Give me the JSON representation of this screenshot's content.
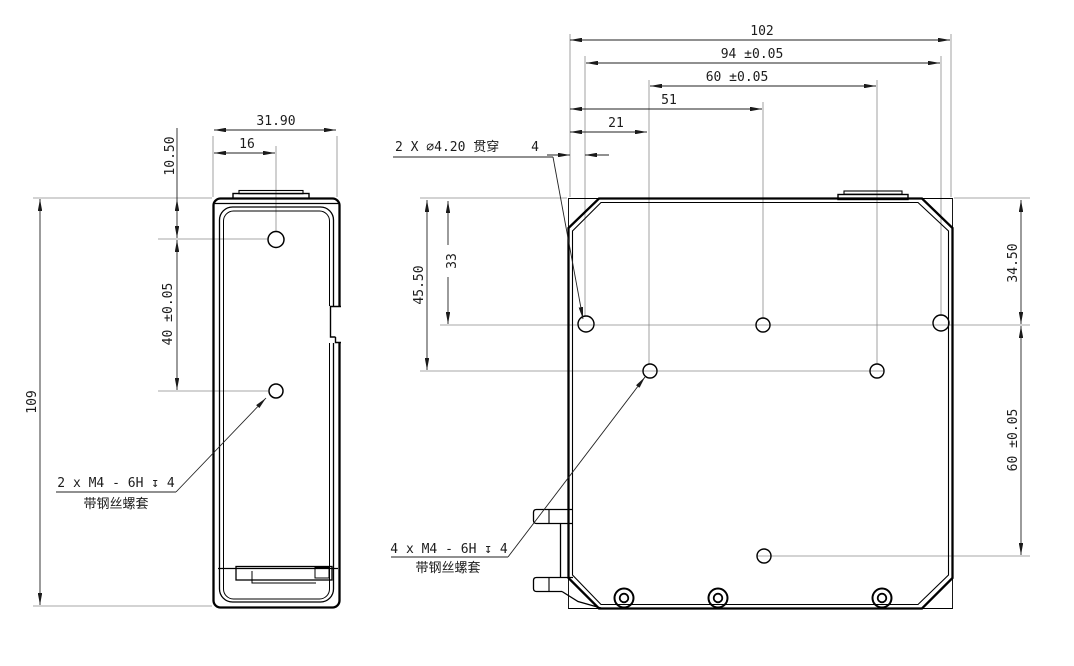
{
  "drawing": {
    "kind": "2-view mechanical part drawing",
    "colors": {
      "background": "#ffffff",
      "part_outline": "#000000",
      "dimension_lines": "#222222",
      "extension_lines": "#8a8a8a",
      "text": "#1c1c1c"
    },
    "side_view": {
      "dim_width": "31.90",
      "dim_hole_offset_x": "16",
      "dim_hole_top_offset": "10.50",
      "dim_hole_spacing": "40 ±0.05",
      "dim_height": "109",
      "thread_note_line1": "2 x M4 - 6H ↧ 4",
      "thread_note_line2": "带钢丝螺套"
    },
    "front_view": {
      "dim_overall_width": "102",
      "dim_hole_span": "94 ±0.05",
      "dim_inner_span": "60 ±0.05",
      "dim_51": "51",
      "dim_21": "21",
      "dim_4": "4",
      "dim_depth_45_50": "45.50",
      "dim_depth_33": "33",
      "dim_right_34_50": "34.50",
      "dim_right_60": "60 ±0.05",
      "hole_note": "2 X ⌀4.20 贯穿",
      "thread_note_line1": "4 x M4 - 6H ↧ 4",
      "thread_note_line2": "带钢丝螺套"
    }
  }
}
